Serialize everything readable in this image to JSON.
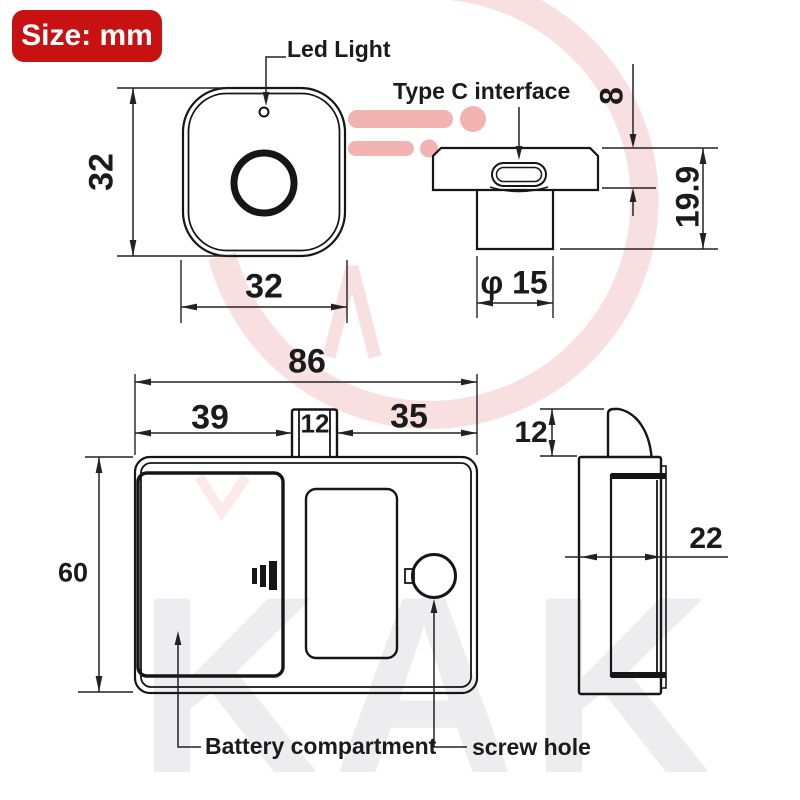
{
  "badge": {
    "label": "Size: mm",
    "bg": "#c81212"
  },
  "watermark": {
    "brand": "KAK",
    "gray": "#ededef",
    "pink_light": "#f8e0e0",
    "pink_strong": "#f1b4b0"
  },
  "front_view": {
    "led_label": "Led Light",
    "dim_height": "32",
    "dim_width": "32"
  },
  "side_sensor_view": {
    "type_c_label": "Type C interface",
    "dim_cap_height": "8",
    "dim_total_height": "19.9",
    "dim_stem_diameter": "φ 15"
  },
  "back_view": {
    "dim_total_width": "86",
    "dim_left": "39",
    "dim_tab": "12",
    "dim_right": "35",
    "dim_height": "60",
    "battery_label": "Battery compartment",
    "screw_label": "screw hole"
  },
  "side_view": {
    "dim_latch_height": "12",
    "dim_depth": "22"
  }
}
